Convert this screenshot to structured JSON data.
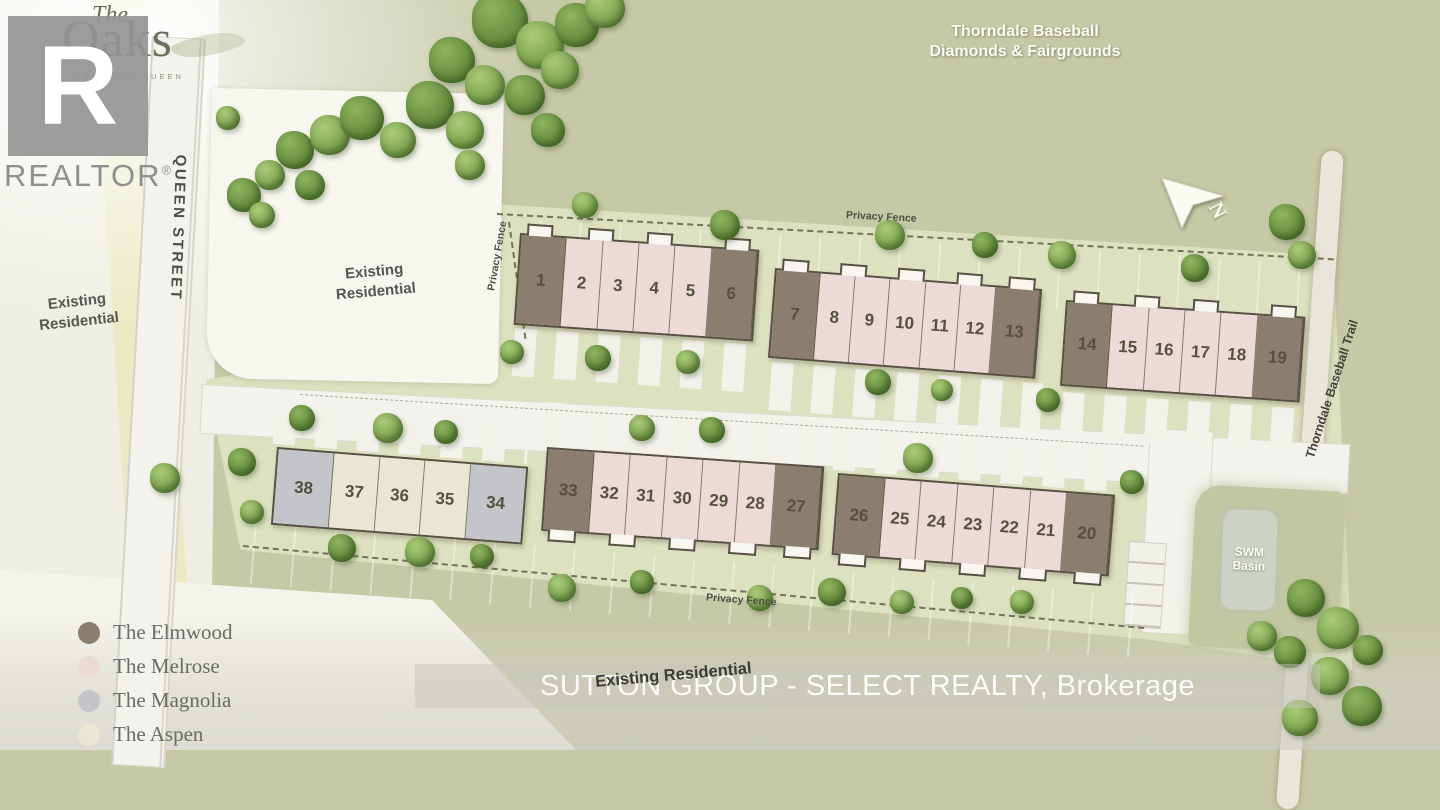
{
  "branding": {
    "the": "The",
    "oaks": "Oaks",
    "tagline": "ON UPPER QUEEN",
    "r": "R",
    "realtor": "REALTOR",
    "reg": "®"
  },
  "labels": {
    "park_line1": "Thorndale Baseball",
    "park_line2": "Diamonds & Fairgrounds",
    "queen": "QUEEN STREET",
    "existing": "Existing Residential",
    "existing_bottom": "Existing Residential",
    "fence": "Privacy Fence",
    "trail": "Thorndale Baseball Trail",
    "swm_line1": "SWM",
    "swm_line2": "Basin",
    "north": "N",
    "watermark": "SUTTON GROUP - SELECT REALTY, Brokerage"
  },
  "models": {
    "elmwood": {
      "label": "The Elmwood",
      "color": "#8b7e6f"
    },
    "melrose": {
      "label": "The Melrose",
      "color": "#ecd9d8"
    },
    "magnolia": {
      "label": "The Magnolia",
      "color": "#c3c5cb"
    },
    "aspen": {
      "label": "The Aspen",
      "color": "#e9e7d3"
    }
  },
  "legend_order": [
    "elmwood",
    "melrose",
    "magnolia",
    "aspen"
  ],
  "buildings": [
    {
      "id": "block-1-6",
      "units": [
        [
          "1",
          "elmwood"
        ],
        [
          "2",
          "melrose"
        ],
        [
          "3",
          "melrose"
        ],
        [
          "4",
          "melrose"
        ],
        [
          "5",
          "melrose"
        ],
        [
          "6",
          "elmwood"
        ]
      ]
    },
    {
      "id": "block-7-13",
      "units": [
        [
          "7",
          "elmwood"
        ],
        [
          "8",
          "melrose"
        ],
        [
          "9",
          "melrose"
        ],
        [
          "10",
          "melrose"
        ],
        [
          "11",
          "melrose"
        ],
        [
          "12",
          "melrose"
        ],
        [
          "13",
          "elmwood"
        ]
      ]
    },
    {
      "id": "block-14-19",
      "units": [
        [
          "14",
          "elmwood"
        ],
        [
          "15",
          "melrose"
        ],
        [
          "16",
          "melrose"
        ],
        [
          "17",
          "melrose"
        ],
        [
          "18",
          "melrose"
        ],
        [
          "19",
          "elmwood"
        ]
      ]
    },
    {
      "id": "block-38-34",
      "units": [
        [
          "38",
          "magnolia"
        ],
        [
          "37",
          "aspen"
        ],
        [
          "36",
          "aspen"
        ],
        [
          "35",
          "aspen"
        ],
        [
          "34",
          "magnolia"
        ]
      ]
    },
    {
      "id": "block-33-27",
      "units": [
        [
          "33",
          "elmwood"
        ],
        [
          "32",
          "melrose"
        ],
        [
          "31",
          "melrose"
        ],
        [
          "30",
          "melrose"
        ],
        [
          "29",
          "melrose"
        ],
        [
          "28",
          "melrose"
        ],
        [
          "27",
          "elmwood"
        ]
      ]
    },
    {
      "id": "block-26-20",
      "units": [
        [
          "26",
          "elmwood"
        ],
        [
          "25",
          "melrose"
        ],
        [
          "24",
          "melrose"
        ],
        [
          "23",
          "melrose"
        ],
        [
          "22",
          "melrose"
        ],
        [
          "21",
          "melrose"
        ],
        [
          "20",
          "elmwood"
        ]
      ]
    }
  ]
}
